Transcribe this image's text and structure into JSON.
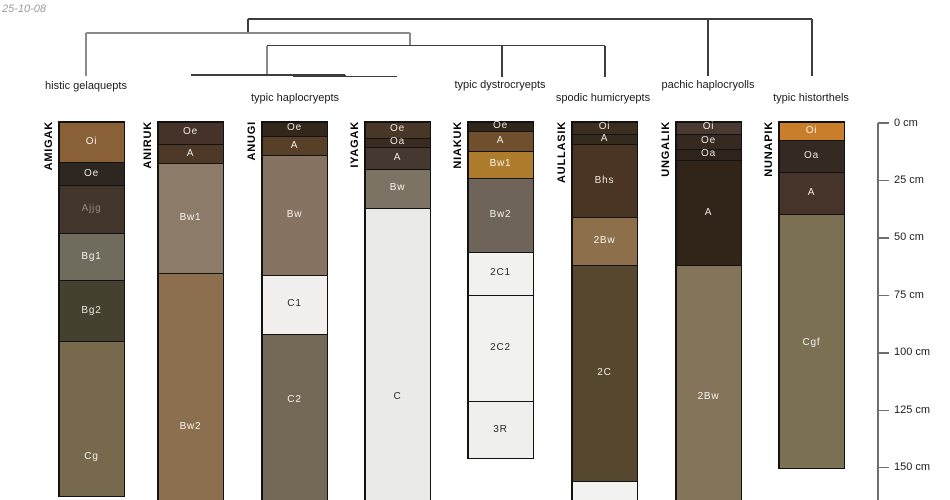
{
  "timestamp": "25-10-08",
  "chart_data": {
    "type": "soil-profile-dendrogram",
    "title": "",
    "depth_unit": "cm",
    "depth_axis_ticks": [
      "0 cm",
      "25 cm",
      "50 cm",
      "75 cm",
      "100 cm",
      "125 cm",
      "150 cm"
    ],
    "dendrogram_topology": "((histic gelaquepts,((typic haplocryepts),(typic dystrocryepts,spodic humicryepts))),(pachic haplocryolls,typic historthels));",
    "groups": [
      {
        "taxon": "histic gelaquepts",
        "profiles": [
          "AMIGAK"
        ]
      },
      {
        "taxon": "typic haplocryepts",
        "profiles": [
          "ANIRUK",
          "ANUGI",
          "IYAGAK"
        ]
      },
      {
        "taxon": "typic dystrocryepts",
        "profiles": [
          "NIAKUK"
        ]
      },
      {
        "taxon": "spodic humicryepts",
        "profiles": [
          "AULLASIK"
        ]
      },
      {
        "taxon": "pachic haplocryolls",
        "profiles": [
          "UNGALIK"
        ]
      },
      {
        "taxon": "typic historthels",
        "profiles": [
          "NUNAPIK"
        ]
      }
    ],
    "profiles_cm": [
      {
        "id": "AMIGAK",
        "horizons": [
          {
            "name": "Oi",
            "top_cm": 0,
            "bottom_cm": 17
          },
          {
            "name": "Oe",
            "top_cm": 17,
            "bottom_cm": 27
          },
          {
            "name": "Ajjg",
            "top_cm": 27,
            "bottom_cm": 48
          },
          {
            "name": "Bg1",
            "top_cm": 48,
            "bottom_cm": 68
          },
          {
            "name": "Bg2",
            "top_cm": 68,
            "bottom_cm": 95
          },
          {
            "name": "Cg",
            "top_cm": 95,
            "bottom_cm": 163
          }
        ]
      },
      {
        "id": "ANIRUK",
        "horizons": [
          {
            "name": "Oe",
            "top_cm": 0,
            "bottom_cm": 9
          },
          {
            "name": "A",
            "top_cm": 9,
            "bottom_cm": 17
          },
          {
            "name": "Bw1",
            "top_cm": 17,
            "bottom_cm": 65
          },
          {
            "name": "Bw2",
            "top_cm": 65,
            "bottom_cm": 164
          }
        ]
      },
      {
        "id": "ANUGI",
        "horizons": [
          {
            "name": "Oe",
            "top_cm": 0,
            "bottom_cm": 6
          },
          {
            "name": "A",
            "top_cm": 6,
            "bottom_cm": 14
          },
          {
            "name": "Bw",
            "top_cm": 14,
            "bottom_cm": 66
          },
          {
            "name": "C1",
            "top_cm": 66,
            "bottom_cm": 92
          },
          {
            "name": "C2",
            "top_cm": 92,
            "bottom_cm": 164
          }
        ]
      },
      {
        "id": "IYAGAK",
        "horizons": [
          {
            "name": "Oe",
            "top_cm": 0,
            "bottom_cm": 7
          },
          {
            "name": "Oa",
            "top_cm": 7,
            "bottom_cm": 10
          },
          {
            "name": "A",
            "top_cm": 10,
            "bottom_cm": 20
          },
          {
            "name": "Bw",
            "top_cm": 20,
            "bottom_cm": 37
          },
          {
            "name": "C",
            "top_cm": 37,
            "bottom_cm": 164
          }
        ]
      },
      {
        "id": "NIAKUK",
        "horizons": [
          {
            "name": "Oe",
            "top_cm": 0,
            "bottom_cm": 4
          },
          {
            "name": "A",
            "top_cm": 4,
            "bottom_cm": 12
          },
          {
            "name": "Bw1",
            "top_cm": 12,
            "bottom_cm": 24
          },
          {
            "name": "Bw2",
            "top_cm": 24,
            "bottom_cm": 56
          },
          {
            "name": "2C1",
            "top_cm": 56,
            "bottom_cm": 75
          },
          {
            "name": "2C2",
            "top_cm": 75,
            "bottom_cm": 121
          },
          {
            "name": "3R",
            "top_cm": 121,
            "bottom_cm": 146
          }
        ]
      },
      {
        "id": "AULLASIK",
        "horizons": [
          {
            "name": "Oi",
            "top_cm": 0,
            "bottom_cm": 5
          },
          {
            "name": "A",
            "top_cm": 5,
            "bottom_cm": 9
          },
          {
            "name": "Bhs",
            "top_cm": 9,
            "bottom_cm": 41
          },
          {
            "name": "2Bw",
            "top_cm": 41,
            "bottom_cm": 62
          },
          {
            "name": "2C",
            "top_cm": 62,
            "bottom_cm": 156
          },
          {
            "name": "",
            "top_cm": 156,
            "bottom_cm": 164
          }
        ]
      },
      {
        "id": "UNGALIK",
        "horizons": [
          {
            "name": "Oi",
            "top_cm": 0,
            "bottom_cm": 5
          },
          {
            "name": "Oe",
            "top_cm": 5,
            "bottom_cm": 11
          },
          {
            "name": "Oa",
            "top_cm": 11,
            "bottom_cm": 16
          },
          {
            "name": "A",
            "top_cm": 16,
            "bottom_cm": 62
          },
          {
            "name": "2Bw",
            "top_cm": 62,
            "bottom_cm": 164
          }
        ]
      },
      {
        "id": "NUNAPIK",
        "horizons": [
          {
            "name": "Oi",
            "top_cm": 0,
            "bottom_cm": 7
          },
          {
            "name": "Oa",
            "top_cm": 7,
            "bottom_cm": 21
          },
          {
            "name": "A",
            "top_cm": 21,
            "bottom_cm": 40
          },
          {
            "name": "Cgf",
            "top_cm": 40,
            "bottom_cm": 151
          }
        ]
      }
    ]
  },
  "dendrogram_px": {
    "dark_color": "#3d3d3d",
    "gray_color": "#8a8a8a",
    "segments": [
      {
        "x1": 248,
        "y1": 19,
        "x2": 812,
        "y2": 19,
        "c": "dark"
      },
      {
        "x1": 248,
        "y1": 19,
        "x2": 248,
        "y2": 33,
        "c": "dark"
      },
      {
        "x1": 812,
        "y1": 19,
        "x2": 812,
        "y2": 76,
        "c": "dark"
      },
      {
        "x1": 708,
        "y1": 19,
        "x2": 708,
        "y2": 76,
        "c": "dark"
      },
      {
        "x1": 86,
        "y1": 33,
        "x2": 410,
        "y2": 33,
        "c": "gray"
      },
      {
        "x1": 86,
        "y1": 33,
        "x2": 86,
        "y2": 76,
        "c": "gray"
      },
      {
        "x1": 410,
        "y1": 33,
        "x2": 410,
        "y2": 45.5,
        "c": "gray"
      },
      {
        "x1": 267,
        "y1": 45.5,
        "x2": 605,
        "y2": 45.5,
        "c": "dark"
      },
      {
        "x1": 502,
        "y1": 45.5,
        "x2": 502,
        "y2": 77,
        "c": "dark"
      },
      {
        "x1": 605,
        "y1": 45.5,
        "x2": 605,
        "y2": 77,
        "c": "dark"
      },
      {
        "x1": 267,
        "y1": 45.5,
        "x2": 267,
        "y2": 75,
        "c": "gray"
      },
      {
        "x1": 191,
        "y1": 75,
        "x2": 345,
        "y2": 75,
        "c": "dark"
      },
      {
        "x1": 345,
        "y1": 75,
        "x2": 345,
        "y2": 76.5,
        "c": "dark"
      },
      {
        "x1": 293,
        "y1": 76.5,
        "x2": 397,
        "y2": 76.5,
        "c": "dark"
      }
    ],
    "labels": [
      {
        "text": "histic gelaquepts",
        "x": 86,
        "y": 87
      },
      {
        "text": "typic haplocryepts",
        "x": 295,
        "y": 99
      },
      {
        "text": "typic dystrocryepts",
        "x": 500,
        "y": 86
      },
      {
        "text": "spodic humicryepts",
        "x": 603,
        "y": 99
      },
      {
        "text": "pachic haplocryolls",
        "x": 708,
        "y": 86
      },
      {
        "text": "typic historthels",
        "x": 811,
        "y": 99
      }
    ]
  },
  "profiles_px": [
    {
      "id": "AMIGAK",
      "x": 58,
      "w": 67,
      "top": 121,
      "bottom": 497,
      "open_bottom": false,
      "horizons": [
        {
          "name": "Oi",
          "top": 121,
          "bottom": 162,
          "color": "#8a6137",
          "label_y": 142,
          "text": "#f4f1ec"
        },
        {
          "name": "Oe",
          "top": 162,
          "bottom": 185,
          "color": "#2e2621",
          "label_y": 174,
          "text": "#eae6e0"
        },
        {
          "name": "Ajjg",
          "top": 185,
          "bottom": 233,
          "color": "#42362c",
          "label_y": 209,
          "text": "#93897d"
        },
        {
          "name": "Bg1",
          "top": 233,
          "bottom": 280,
          "color": "#6f6b5d",
          "label_y": 257,
          "text": "#f2f0ec"
        },
        {
          "name": "Bg2",
          "top": 280,
          "bottom": 341,
          "color": "#454130",
          "label_y": 311,
          "text": "#e8e5de"
        },
        {
          "name": "Cg",
          "top": 341,
          "bottom": 497,
          "color": "#776a4c",
          "label_y": 457,
          "text": "#f2efe8"
        }
      ]
    },
    {
      "id": "ANIRUK",
      "x": 157,
      "w": 67,
      "top": 121,
      "bottom": 500,
      "open_bottom": true,
      "horizons": [
        {
          "name": "Oe",
          "top": 121,
          "bottom": 144,
          "color": "#45332a",
          "label_y": 132,
          "text": "#ece7e1"
        },
        {
          "name": "A",
          "top": 144,
          "bottom": 163,
          "color": "#4e3827",
          "label_y": 154,
          "text": "#ece7e1"
        },
        {
          "name": "Bw1",
          "top": 163,
          "bottom": 273,
          "color": "#8c7b68",
          "label_y": 218,
          "text": "#f6f4f0"
        },
        {
          "name": "Bw2",
          "top": 273,
          "bottom": 500,
          "color": "#8c6f4e",
          "label_y": 427,
          "text": "#f6f2ea"
        }
      ]
    },
    {
      "id": "ANUGI",
      "x": 261,
      "w": 67,
      "top": 121,
      "bottom": 500,
      "open_bottom": true,
      "horizons": [
        {
          "name": "Oe",
          "top": 121,
          "bottom": 136,
          "color": "#33271b",
          "label_y": 128,
          "text": "#e9e4dd"
        },
        {
          "name": "A",
          "top": 136,
          "bottom": 155,
          "color": "#573f28",
          "label_y": 146,
          "text": "#efeae2"
        },
        {
          "name": "Bw",
          "top": 155,
          "bottom": 275,
          "color": "#867361",
          "label_y": 215,
          "text": "#f5f3ef"
        },
        {
          "name": "C1",
          "top": 275,
          "bottom": 334,
          "color": "#f1f0ee",
          "label_y": 304,
          "text": "#2b2b2b"
        },
        {
          "name": "C2",
          "top": 334,
          "bottom": 500,
          "color": "#746857",
          "label_y": 400,
          "text": "#f2f0eb"
        }
      ]
    },
    {
      "id": "IYAGAK",
      "x": 364,
      "w": 67,
      "top": 121,
      "bottom": 500,
      "open_bottom": true,
      "horizons": [
        {
          "name": "Oe",
          "top": 121,
          "bottom": 138,
          "color": "#483626",
          "label_y": 129,
          "text": "#ece7e0"
        },
        {
          "name": "Oa",
          "top": 138,
          "bottom": 147,
          "color": "#3a2b20",
          "label_y": 142,
          "text": "#e9e4dd"
        },
        {
          "name": "A",
          "top": 147,
          "bottom": 169,
          "color": "#443831",
          "label_y": 158,
          "text": "#ebe7e1"
        },
        {
          "name": "Bw",
          "top": 169,
          "bottom": 208,
          "color": "#7d7365",
          "label_y": 188,
          "text": "#f4f2ee"
        },
        {
          "name": "C",
          "top": 208,
          "bottom": 500,
          "color": "#eaeae8",
          "label_y": 397,
          "text": "#2b2b2b"
        }
      ]
    },
    {
      "id": "NIAKUK",
      "x": 467,
      "w": 67,
      "top": 121,
      "bottom": 459,
      "open_bottom": false,
      "horizons": [
        {
          "name": "Oe",
          "top": 121,
          "bottom": 131,
          "color": "#32261b",
          "label_y": 126,
          "text": "#e9e4dd"
        },
        {
          "name": "A",
          "top": 131,
          "bottom": 151,
          "color": "#6f4f2d",
          "label_y": 141,
          "text": "#f2ede5"
        },
        {
          "name": "Bw1",
          "top": 151,
          "bottom": 178,
          "color": "#ad7c2c",
          "label_y": 164,
          "text": "#f7f2e8"
        },
        {
          "name": "Bw2",
          "top": 178,
          "bottom": 252,
          "color": "#6f6459",
          "label_y": 215,
          "text": "#f3f1ed"
        },
        {
          "name": "2C1",
          "top": 252,
          "bottom": 295,
          "color": "#f1f1ef",
          "label_y": 273,
          "text": "#2b2b2b"
        },
        {
          "name": "2C2",
          "top": 295,
          "bottom": 401,
          "color": "#f1f1ef",
          "label_y": 348,
          "text": "#2b2b2b"
        },
        {
          "name": "3R",
          "top": 401,
          "bottom": 459,
          "color": "#efefed",
          "label_y": 430,
          "text": "#2b2b2b"
        }
      ]
    },
    {
      "id": "AULLASIK",
      "x": 571,
      "w": 67,
      "top": 121,
      "bottom": 500,
      "open_bottom": true,
      "horizons": [
        {
          "name": "Oi",
          "top": 121,
          "bottom": 134,
          "color": "#3c2e1f",
          "label_y": 127,
          "text": "#ebe6df"
        },
        {
          "name": "A",
          "top": 134,
          "bottom": 144,
          "color": "#342a1e",
          "label_y": 139,
          "text": "#e9e4dd"
        },
        {
          "name": "Bhs",
          "top": 144,
          "bottom": 217,
          "color": "#4a3424",
          "label_y": 181,
          "text": "#ece6df"
        },
        {
          "name": "2Bw",
          "top": 217,
          "bottom": 265,
          "color": "#8d6f4b",
          "label_y": 241,
          "text": "#f6f2ea"
        },
        {
          "name": "2C",
          "top": 265,
          "bottom": 481,
          "color": "#55482f",
          "label_y": 373,
          "text": "#eeebe3"
        },
        {
          "name": "",
          "top": 481,
          "bottom": 500,
          "color": "#f2f2f0",
          "label_y": null,
          "text": "#2b2b2b"
        }
      ]
    },
    {
      "id": "UNGALIK",
      "x": 675,
      "w": 67,
      "top": 121,
      "bottom": 500,
      "open_bottom": true,
      "horizons": [
        {
          "name": "Oi",
          "top": 121,
          "bottom": 134,
          "color": "#4a3930",
          "label_y": 127,
          "text": "#ece8e2"
        },
        {
          "name": "Oe",
          "top": 134,
          "bottom": 149,
          "color": "#362a20",
          "label_y": 141,
          "text": "#e9e5de"
        },
        {
          "name": "Oa",
          "top": 149,
          "bottom": 160,
          "color": "#2e241b",
          "label_y": 154,
          "text": "#e8e3dc"
        },
        {
          "name": "A",
          "top": 160,
          "bottom": 265,
          "color": "#31251a",
          "label_y": 213,
          "text": "#e9e4dd"
        },
        {
          "name": "2Bw",
          "top": 265,
          "bottom": 500,
          "color": "#84755a",
          "label_y": 397,
          "text": "#f5f3ee"
        }
      ]
    },
    {
      "id": "NUNAPIK",
      "x": 778,
      "w": 67,
      "top": 121,
      "bottom": 469,
      "open_bottom": false,
      "horizons": [
        {
          "name": "Oi",
          "top": 121,
          "bottom": 140,
          "color": "#c87e2b",
          "label_y": 131,
          "text": "#faf4ea"
        },
        {
          "name": "Oa",
          "top": 140,
          "bottom": 172,
          "color": "#342a21",
          "label_y": 156,
          "text": "#e9e5de"
        },
        {
          "name": "A",
          "top": 172,
          "bottom": 214,
          "color": "#46342a",
          "label_y": 193,
          "text": "#ebe6e0"
        },
        {
          "name": "Cgf",
          "top": 214,
          "bottom": 469,
          "color": "#7b7054",
          "label_y": 343,
          "text": "#f3f1ea"
        }
      ]
    }
  ],
  "depth_axis_px": {
    "x": 878,
    "top_y": 123,
    "bottom_y": 500,
    "px_per_cm": 2.298,
    "tick_len": 11,
    "ticks": [
      {
        "label": "0 cm",
        "depth": 0
      },
      {
        "label": "25 cm",
        "depth": 25
      },
      {
        "label": "50 cm",
        "depth": 50
      },
      {
        "label": "75 cm",
        "depth": 75
      },
      {
        "label": "100 cm",
        "depth": 100
      },
      {
        "label": "125 cm",
        "depth": 125
      },
      {
        "label": "150 cm",
        "depth": 150
      }
    ]
  }
}
